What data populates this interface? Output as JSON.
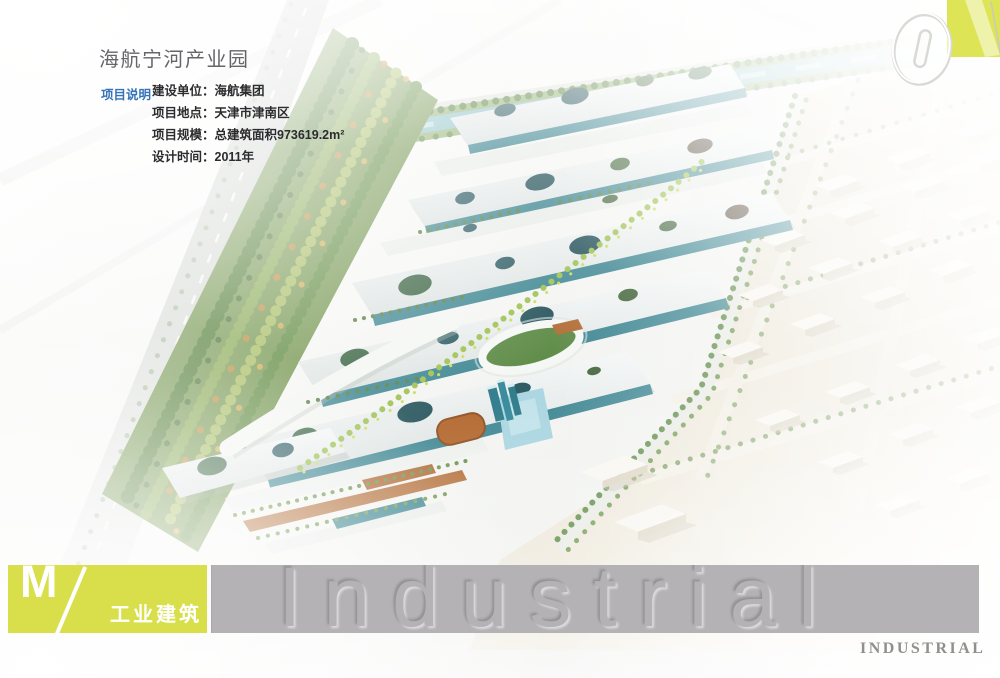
{
  "header": {
    "title": "海航宁河产业园"
  },
  "info": {
    "label": "项目说明",
    "rows": [
      "建设单位：海航集团",
      "项目地点：天津市津南区",
      "项目规模：总建筑面积973619.2m²",
      "设计时间：2011年"
    ]
  },
  "page_number": {
    "value": "01"
  },
  "footer": {
    "logo_letter": "M",
    "logo_slash": "/",
    "category_label": "工业建筑",
    "watermark_embossed": "Industrial",
    "watermark_small": "INDUSTRIAL"
  },
  "colors": {
    "accent_yellow_green": "#d8df4a",
    "watermark_band_gray": "#b5b2b5",
    "info_label_blue": "#3572b8",
    "title_gray": "#66666a"
  }
}
